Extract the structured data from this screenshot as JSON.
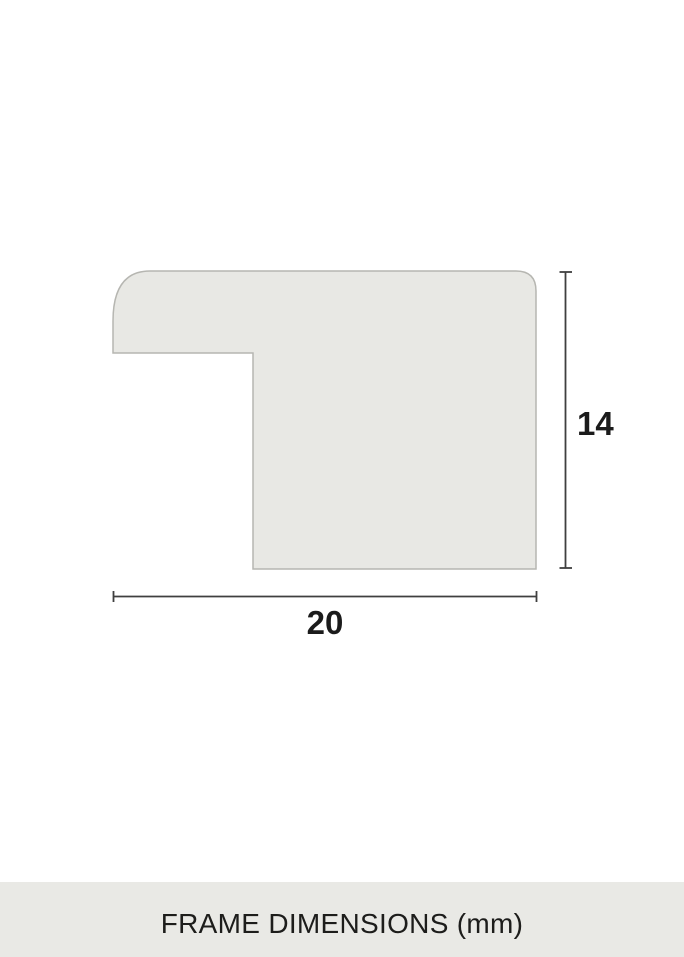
{
  "diagram": {
    "description": "frame moulding profile cross-section",
    "height_dimension": {
      "label": "14"
    },
    "width_dimension": {
      "label": "20"
    },
    "units": "mm"
  },
  "caption": {
    "text": "FRAME DIMENSIONS (mm)"
  },
  "colors": {
    "background": "#ffffff",
    "profile_fill": "#e8e8e4",
    "profile_stroke": "#b6b6b1",
    "dimension_line": "#3f3f3f",
    "label_text": "#1b1b1b",
    "caption_bg": "#e9e9e5",
    "caption_text": "#1d1d1b"
  }
}
